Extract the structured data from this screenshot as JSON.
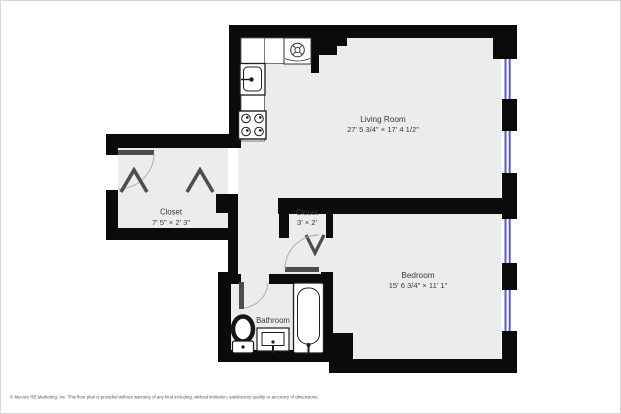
{
  "floorplan": {
    "title": "One-bedroom apartment floor plan",
    "rooms": [
      {
        "name": "Living Room",
        "dimensions": "27' 5 3/4\" × 17' 4 1/2\""
      },
      {
        "name": "Bedroom",
        "dimensions": "15' 6 3/4\" × 11' 1\""
      },
      {
        "name": "Closet",
        "dimensions": "7' 5\" × 2' 3\""
      },
      {
        "name": "Closet",
        "dimensions": "3' × 2'"
      },
      {
        "name": "Bathroom",
        "dimensions": ""
      }
    ],
    "fixtures": [
      "washer-dryer",
      "kitchen-sink",
      "stove",
      "toilet",
      "bathroom-sink",
      "bathtub"
    ],
    "doors": [
      "entry-swing-door",
      "closet-bifold-door-left",
      "closet-bifold-door-right",
      "small-closet-bifold-door",
      "bedroom-swing-door",
      "bathroom-swing-door"
    ],
    "window_count": 4,
    "colors": {
      "wall": "#0b0b0b",
      "floor": "#ececec",
      "window": "#5659d6",
      "door_leaf": "#4d4d4d"
    },
    "footer": "© Mecure RE Marketing, Inc. This floor plan is provided without warranty of any kind including, without limitation, satisfactory quality or accuracy of dimensions."
  }
}
